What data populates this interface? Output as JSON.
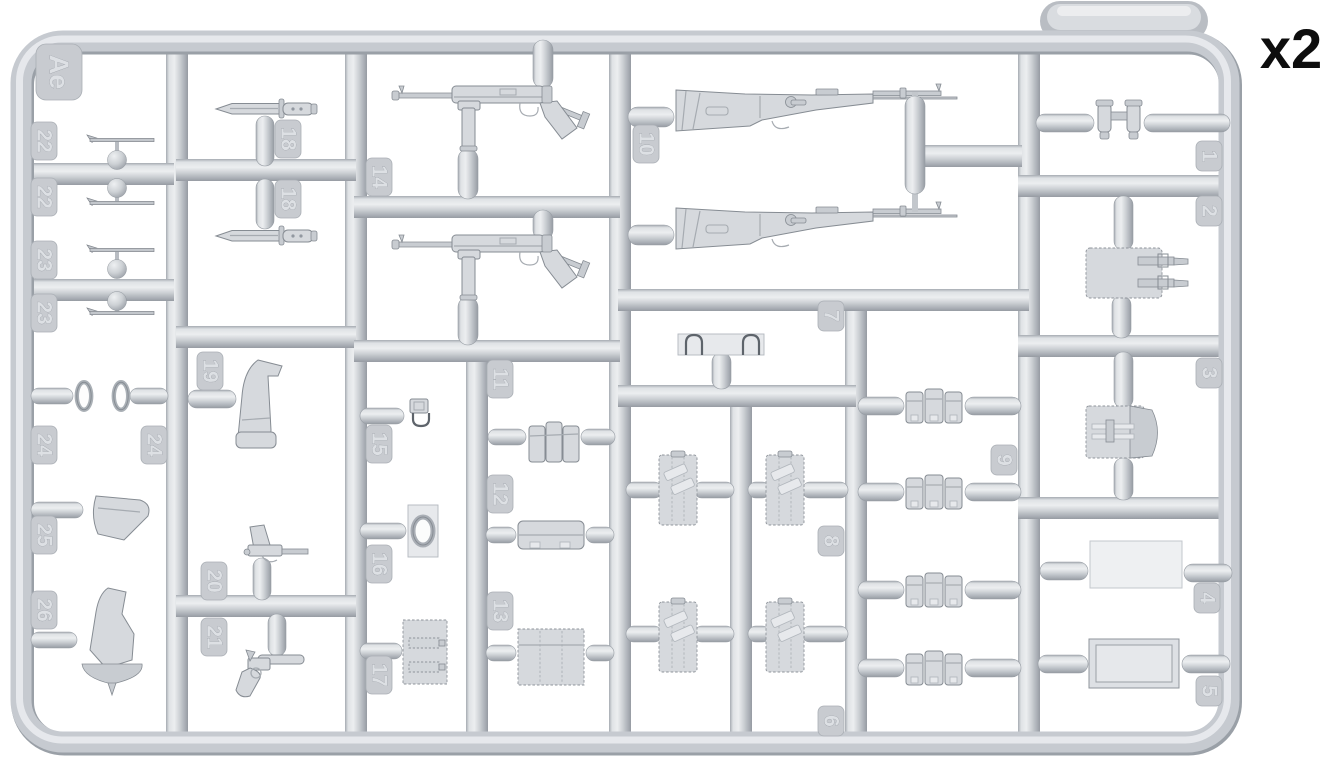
{
  "quantity_label": "x2",
  "sprue_code": "Ae",
  "plastic_color": "#c9ccd1",
  "background_color": "#ffffff",
  "parts": [
    {
      "number": "1",
      "description": "binoculars",
      "copies_on_sprue": 1
    },
    {
      "number": "2",
      "description": "flat case with two strap buckles",
      "copies_on_sprue": 1
    },
    {
      "number": "3",
      "description": "pouch with opened side flap",
      "copies_on_sprue": 1
    },
    {
      "number": "4",
      "description": "plain flat rectangular sheet",
      "copies_on_sprue": 1
    },
    {
      "number": "5",
      "description": "rectangular tray / lid panel",
      "copies_on_sprue": 1
    },
    {
      "number": "6",
      "description": "canvas bag with stick grenades",
      "copies_on_sprue": 2
    },
    {
      "number": "7",
      "description": "bracket plate with two hooks",
      "copies_on_sprue": 1
    },
    {
      "number": "8",
      "description": "canvas bag with stick grenades",
      "copies_on_sprue": 2
    },
    {
      "number": "9",
      "description": "three-pocket rifle ammo pouch set",
      "copies_on_sprue": 4
    },
    {
      "number": "10",
      "description": "bolt-action rifle",
      "copies_on_sprue": 2
    },
    {
      "number": "11",
      "description": "three-cell magazine pouch",
      "copies_on_sprue": 1
    },
    {
      "number": "12",
      "description": "long flat case",
      "copies_on_sprue": 1
    },
    {
      "number": "13",
      "description": "three-cell magazine pouch with flap",
      "copies_on_sprue": 1
    },
    {
      "number": "14",
      "description": "submachine gun with folded stock",
      "copies_on_sprue": 2
    },
    {
      "number": "15",
      "description": "small buckle / clip",
      "copies_on_sprue": 1
    },
    {
      "number": "16",
      "description": "oval ring on backing plate",
      "copies_on_sprue": 1
    },
    {
      "number": "17",
      "description": "stitched double pouch",
      "copies_on_sprue": 1
    },
    {
      "number": "18",
      "description": "bayonet",
      "copies_on_sprue": 2
    },
    {
      "number": "19",
      "description": "large pistol holster",
      "copies_on_sprue": 1
    },
    {
      "number": "20",
      "description": "pistol",
      "copies_on_sprue": 1
    },
    {
      "number": "21",
      "description": "flare pistol",
      "copies_on_sprue": 1
    },
    {
      "number": "22",
      "description": "thin rod with angled tip",
      "copies_on_sprue": 2
    },
    {
      "number": "23",
      "description": "thin rod with angled tip",
      "copies_on_sprue": 2
    },
    {
      "number": "24",
      "description": "oval lens ring",
      "copies_on_sprue": 2
    },
    {
      "number": "25",
      "description": "pistol holster",
      "copies_on_sprue": 1
    },
    {
      "number": "26",
      "description": "holster with pointed base",
      "copies_on_sprue": 1
    }
  ]
}
